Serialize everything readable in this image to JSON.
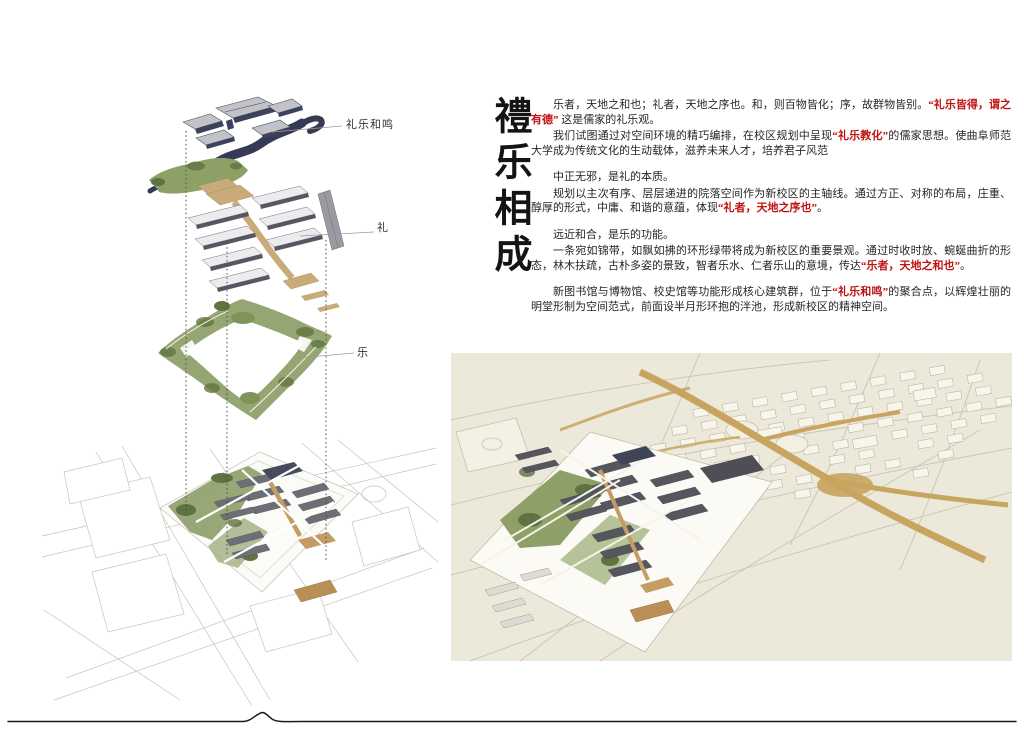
{
  "title": {
    "text": "禮乐相成"
  },
  "diagram": {
    "labels": {
      "heming": "礼乐和鸣",
      "li": "礼",
      "yue": "乐"
    }
  },
  "article": {
    "paragraphs": [
      {
        "segments": [
          "乐者，天地之和也；礼者，天地之序也。和，则百物皆化；序，故群物皆别。",
          "“礼乐皆得，谓之有德”",
          " 这是儒家的礼乐观。"
        ]
      },
      {
        "segments": [
          "我们试图通过对空间环境的精巧编排，在校区规划中呈现",
          "“礼乐教化”",
          "的儒家思想。使曲阜师范大学成为传统文化的生动载体，滋养未来人才，培养君子风范"
        ]
      },
      {
        "segments": [
          "中正无邪，是礼的本质。"
        ]
      },
      {
        "segments": [
          "规划以主次有序、层层递进的院落空间作为新校区的主轴线。通过方正、对称的布局，庄重、醇厚的形式，中庸、和谐的意蕴，体现",
          "“礼者，天地之序也”",
          "。"
        ]
      },
      {
        "segments": [
          "远近和合，是乐的功能。"
        ]
      },
      {
        "segments": [
          "一条宛如锦带，如飘如拂的环形绿带将成为新校区的重要景观。通过时收时放、蜿蜒曲折的形态，林木扶疏，古朴多姿的景致，智者乐水、仁者乐山的意境，传达",
          "“乐者，天地之和也”",
          "。"
        ]
      },
      {
        "segments": [
          "新图书馆与博物馆、校史馆等功能形成核心建筑群，位于",
          "“礼乐和鸣”",
          "的聚合点，以辉煌壮丽的明堂形制为空间范式，前面设半月形环抱的泮池，形成新校区的精神空间。"
        ]
      }
    ]
  },
  "palette": {
    "accent_red": "#c11212",
    "ink": "#1c1c1c",
    "navy_water": "#353b54",
    "building_gray": "#6e6f76",
    "roof_white": "#ececef",
    "landscape_green": "#8da167",
    "path_tan": "#c9ab79",
    "render_background": "#ece9da"
  }
}
